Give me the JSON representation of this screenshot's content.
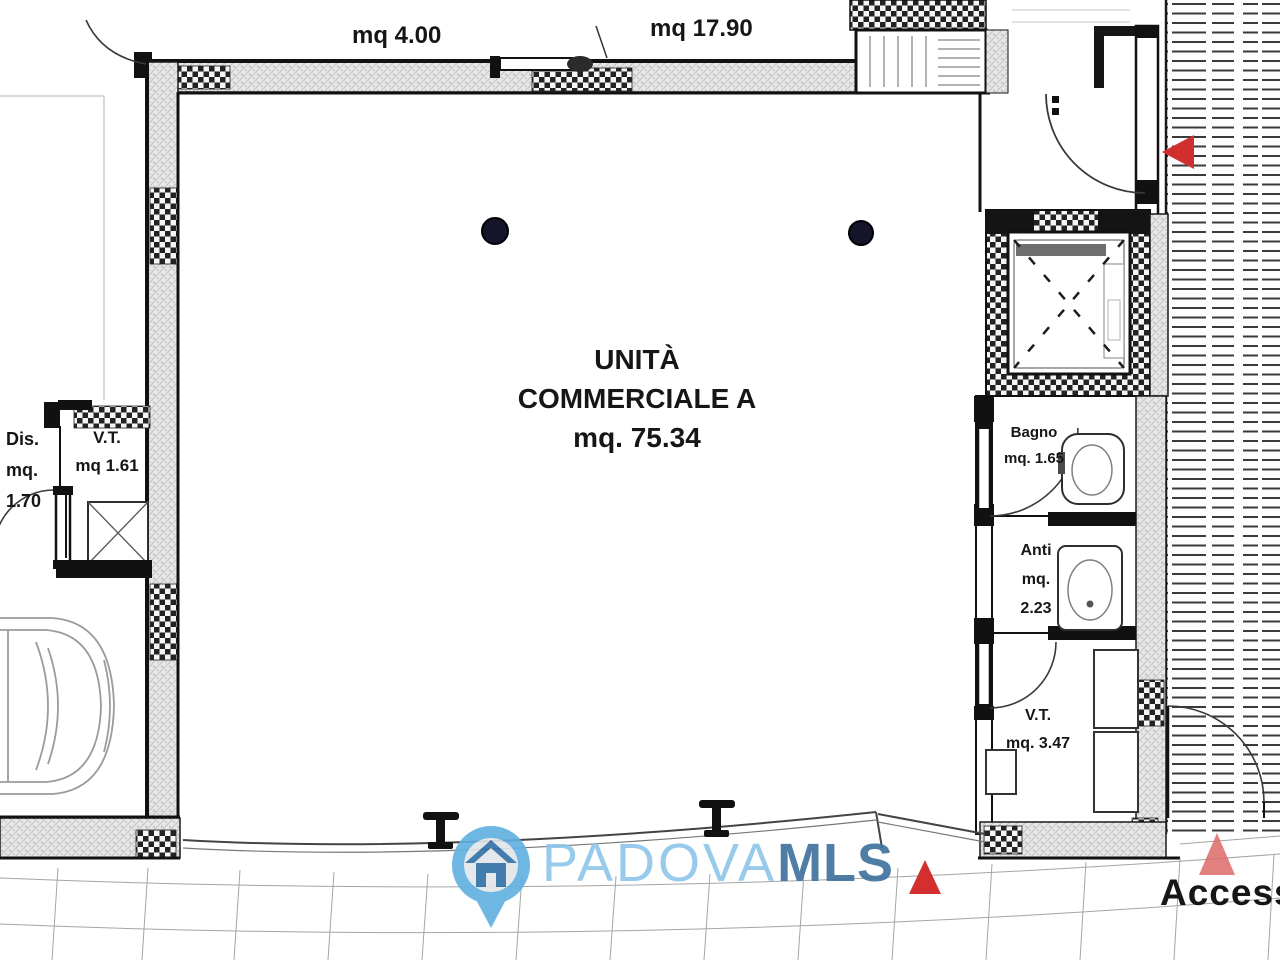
{
  "unit": {
    "title_line1": "UNITÀ",
    "title_line2": "COMMERCIALE A",
    "area": "mq. 75.34"
  },
  "annotations": {
    "top_left_area": "mq 4.00",
    "top_right_area": "mq 17.90",
    "access": "Accesso"
  },
  "rooms": [
    {
      "id": "dis",
      "lines": [
        "Dis.",
        "mq.",
        "1.70"
      ]
    },
    {
      "id": "vt_left",
      "lines": [
        "V.T.",
        "mq 1.61"
      ]
    },
    {
      "id": "bagno",
      "lines": [
        "Bagno",
        "mq. 1.65"
      ]
    },
    {
      "id": "anti",
      "lines": [
        "Anti",
        "mq.",
        "2.23"
      ]
    },
    {
      "id": "vt_right",
      "lines": [
        "V.T.",
        "mq. 3.47"
      ]
    }
  ],
  "watermark": {
    "brand": "PADOVA",
    "brand_suffix": "MLS",
    "icon": "house-pin-icon"
  },
  "colors": {
    "wall_fill": "#e7e7e7",
    "line": "#1a1a1a",
    "arrow_red": "#cf2f2f",
    "arrow_pink": "#dd6a6a",
    "pin_blue": "#5fb0e0",
    "pin_inner": "#e3e6e9",
    "house_blue": "#2f6fa5",
    "brand_light": "#8cc5e9",
    "brand_dark": "#3d6f9c"
  }
}
